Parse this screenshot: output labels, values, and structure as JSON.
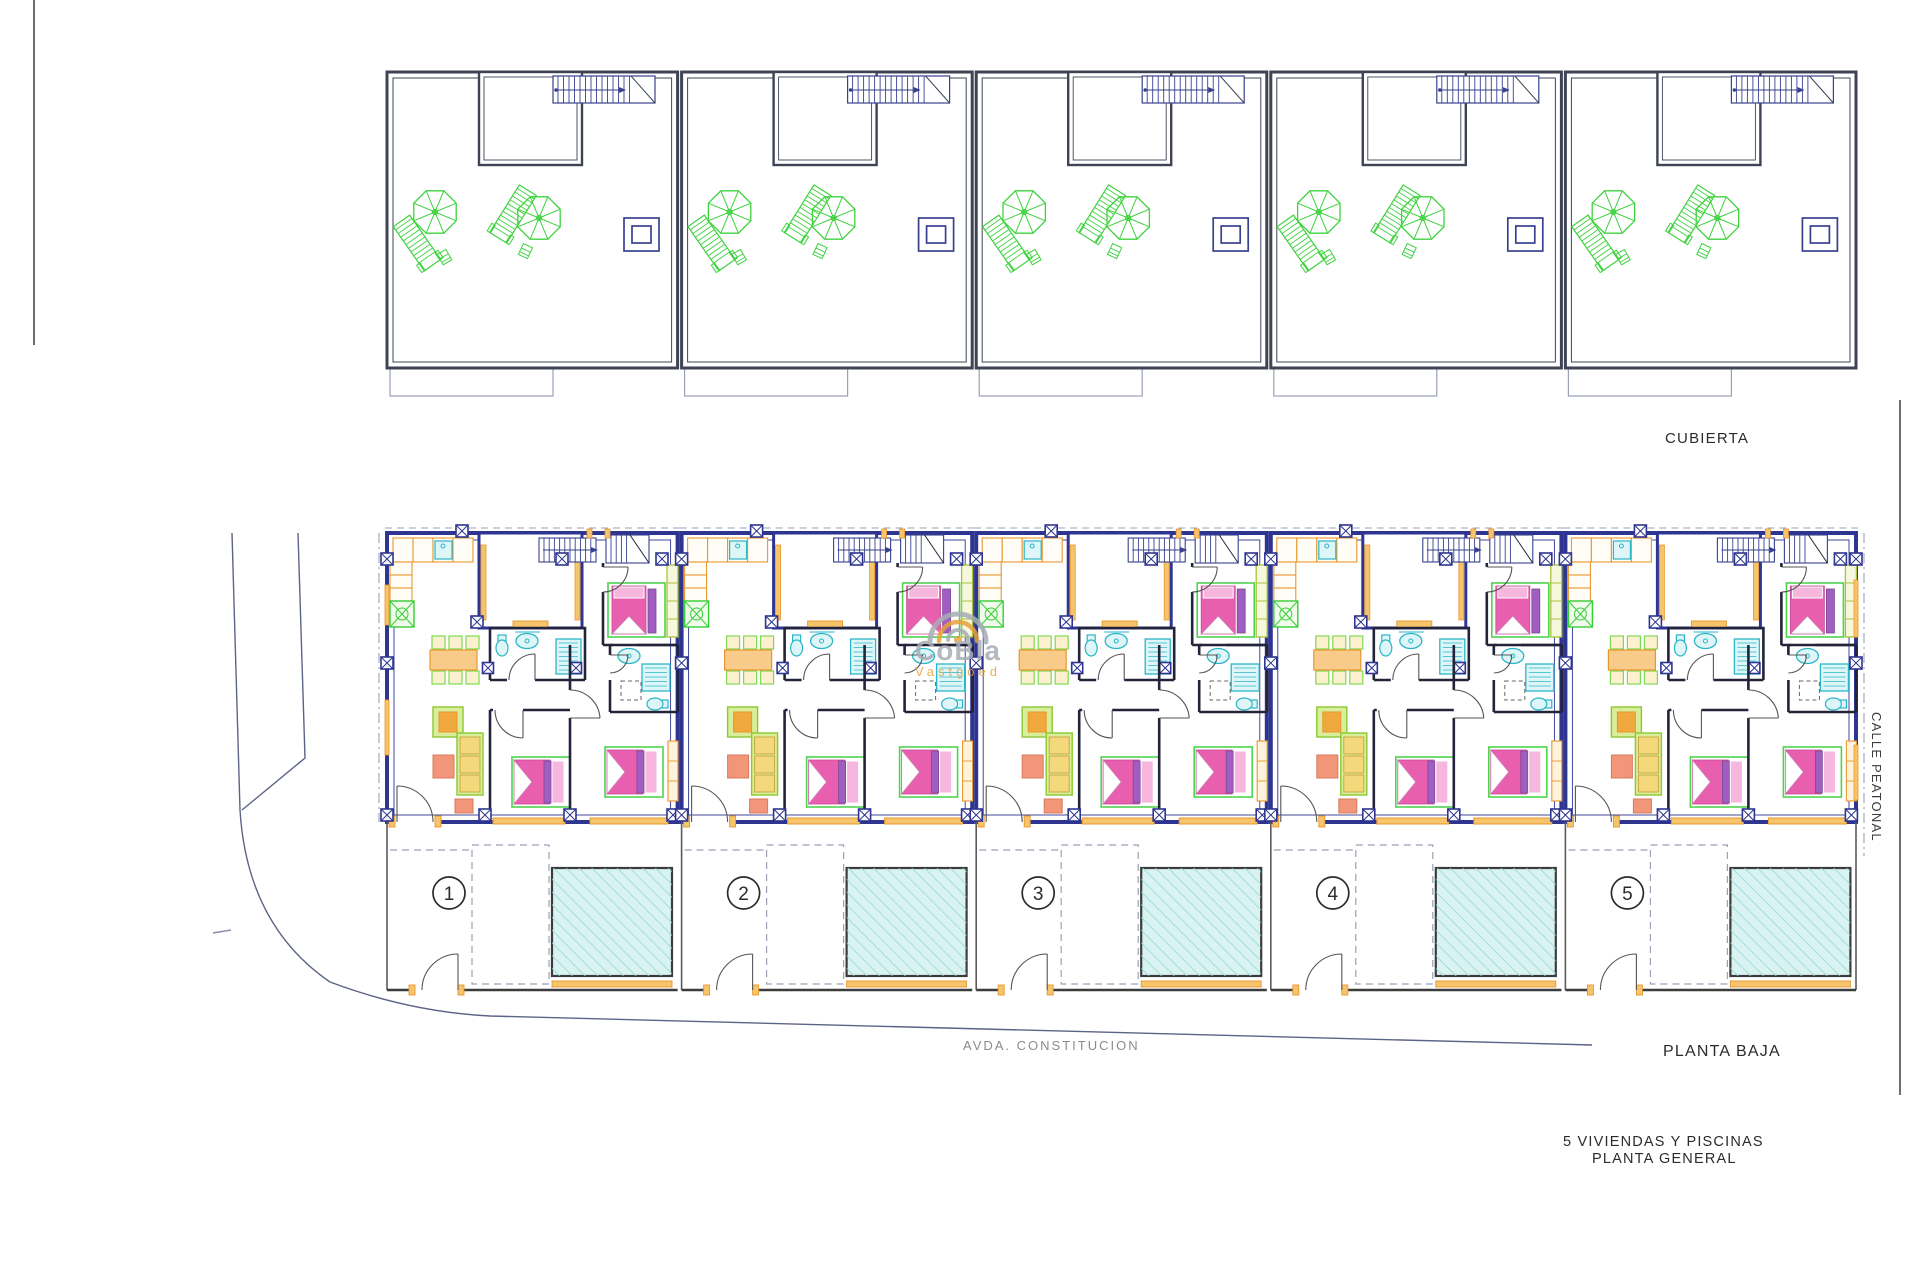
{
  "labels": {
    "cubierta": "CUBIERTA",
    "planta_baja": "PLANTA  BAJA",
    "calle_peatonal": "CALLE  PEATONAL",
    "street_bottom": "AVDA. CONSTITUCION",
    "project_line1": "5 VIVIENDAS Y PISCINAS",
    "project_line2": "PLANTA GENERAL"
  },
  "watermark": {
    "line1": "CoBla",
    "line2": "Vastgoed"
  },
  "units": [
    {
      "number": "1"
    },
    {
      "number": "2"
    },
    {
      "number": "3"
    },
    {
      "number": "4"
    },
    {
      "number": "5"
    }
  ],
  "colors": {
    "wall_navy": "#2d3590",
    "wall_black": "#23233a",
    "roof_line": "#3f4455",
    "stair_blue": "#39418f",
    "orange": "#e8972f",
    "orange_fill": "#f6c46a",
    "orange_pale": "#fff3dc",
    "cyan": "#29b6c8",
    "cyan_fill": "#dff6f8",
    "pink": "#e85fb0",
    "pink_light": "#f6b6dd",
    "purple": "#a05fc0",
    "green_frame": "#4ed44e",
    "green_soft": "#8bc832",
    "lime_fill": "#d9ee9a",
    "cushion": "#f3d97c",
    "salmon": "#f2967a",
    "peach": "#f8cb8a",
    "cream": "#fdf0cf",
    "plant_green": "#35d035",
    "roof_green": "#3fd23f",
    "pool_fill": "#d8f3f1",
    "pool_hatch": "#8fd8d2",
    "dash_gray": "#9aa0b8",
    "line_gray": "#5b6387",
    "text_dark": "#2b2b2b",
    "wardrobe_lime": "#aac23a",
    "watermark_gray": "#a7adb5",
    "watermark_orange": "#e8a23c"
  }
}
